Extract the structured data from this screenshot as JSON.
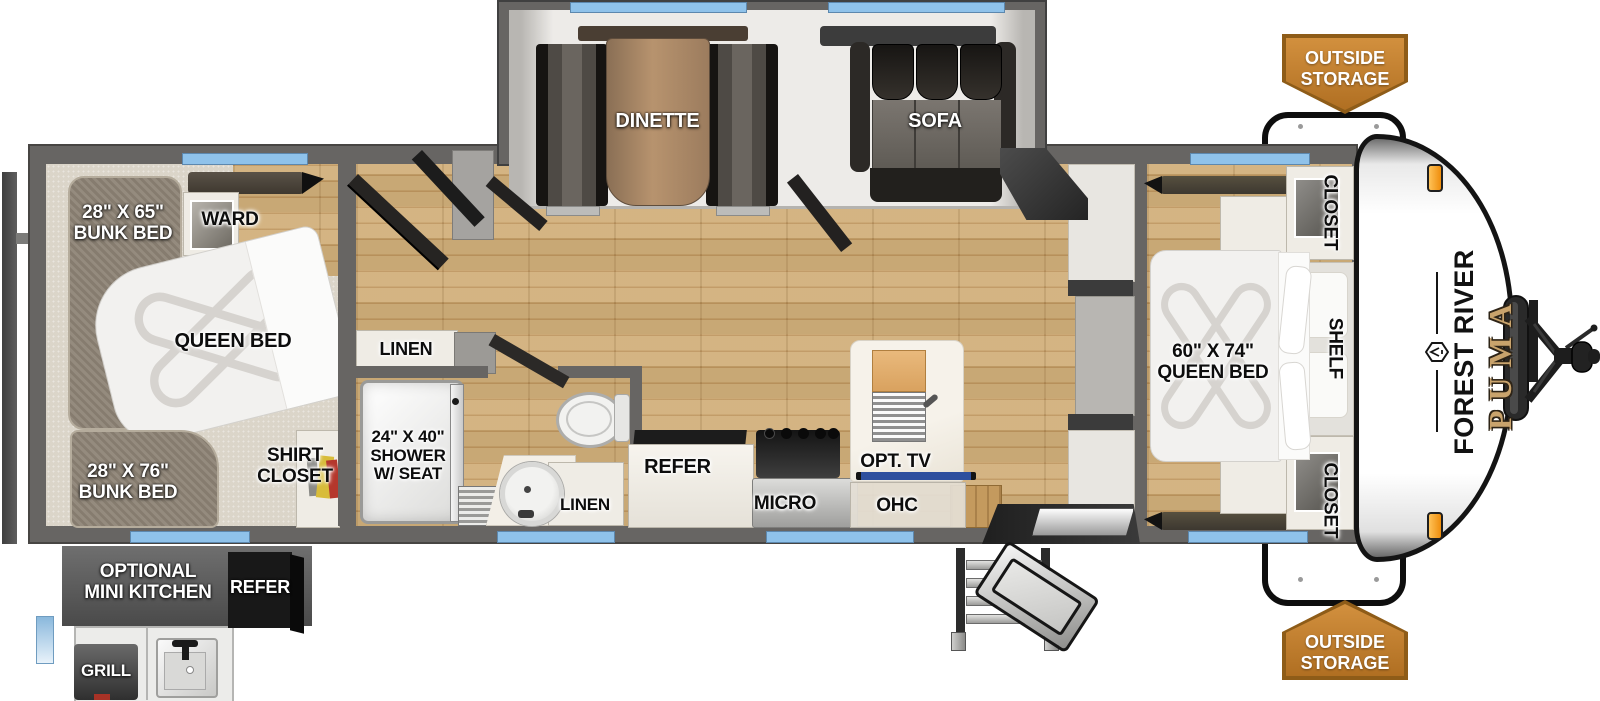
{
  "floorplan": {
    "bunk_room": {
      "bunk_top_l1": "28\" X 65\"",
      "bunk_top_l2": "BUNK BED",
      "ward": "WARD",
      "queen_bed": "QUEEN BED",
      "bunk_bottom_l1": "28\" X 76\"",
      "bunk_bottom_l2": "BUNK BED",
      "shirt_closet_l1": "SHIRT",
      "shirt_closet_l2": "CLOSET"
    },
    "bathroom": {
      "linen_upper": "LINEN",
      "shower_l1": "24\" X 40\"",
      "shower_l2": "SHOWER",
      "shower_l3": "W/ SEAT",
      "linen_lower": "LINEN"
    },
    "living_area": {
      "dinette": "DINETTE",
      "sofa": "SOFA"
    },
    "kitchen": {
      "refer": "REFER",
      "micro": "MICRO",
      "ohc": "OHC",
      "opt_tv": "OPT. TV"
    },
    "master_bedroom": {
      "queen_bed_l1": "60\" X 74\"",
      "queen_bed_l2": "QUEEN BED",
      "closet_top": "CLOSET",
      "shelf": "SHELF",
      "closet_bottom": "CLOSET"
    },
    "exterior": {
      "storage_top_l1": "OUTSIDE",
      "storage_top_l2": "STORAGE",
      "storage_bottom_l1": "OUTSIDE",
      "storage_bottom_l2": "STORAGE",
      "brand": "FOREST RIVER",
      "model": "PUMA",
      "mini_kitchen_l1": "OPTIONAL",
      "mini_kitchen_l2": "MINI KITCHEN",
      "mini_refer": "REFER",
      "grill": "GRILL"
    },
    "colors": {
      "window_blue": "#8fc2ea",
      "badge_orange": "#c07a28",
      "wood_floor": "#c8a26a",
      "brand_gold": "#c9a36c"
    }
  }
}
